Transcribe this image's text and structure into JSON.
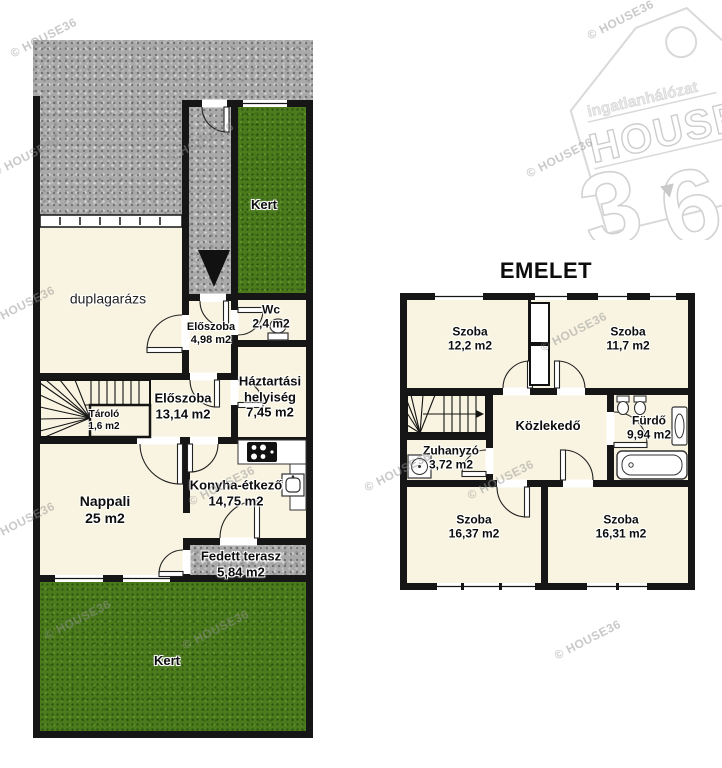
{
  "watermark": {
    "text": "© HOUSE36"
  },
  "logo": {
    "network": "ingatlanhálózat",
    "brand": "HOUSE",
    "digit_left": "3",
    "digit_right": "6"
  },
  "ground_floor": {
    "garage": {
      "name": "duplagarázs"
    },
    "kert_top": {
      "name": "Kert"
    },
    "wc": {
      "name": "Wc",
      "area": "2,4 m2"
    },
    "eloszoba_small": {
      "name": "Előszoba",
      "area": "4,98 m2"
    },
    "eloszoba_large": {
      "name": "Előszoba",
      "area": "13,14 m2"
    },
    "haztartasi": {
      "name_line1": "Háztartási",
      "name_line2": "helyiség",
      "area": "7,45 m2"
    },
    "tarolo": {
      "name": "Tároló",
      "area": "1,6 m2"
    },
    "nappali": {
      "name": "Nappali",
      "area": "25 m2"
    },
    "konyha": {
      "name": "Konyha-étkező",
      "area": "14,75 m2"
    },
    "terasz": {
      "name": "Fedett terasz",
      "area": "5,84 m2"
    },
    "kert_bottom": {
      "name": "Kert"
    }
  },
  "upper_floor": {
    "title": "EMELET",
    "szoba_top_left": {
      "name": "Szoba",
      "area": "12,2 m2"
    },
    "szoba_top_right": {
      "name": "Szoba",
      "area": "11,7 m2"
    },
    "kozlekedo": {
      "name": "Közlekedő"
    },
    "furdo": {
      "name": "Fürdő",
      "area": "9,94 m2"
    },
    "zuhanyzo": {
      "name": "Zuhanyzó",
      "area": "3,72 m2"
    },
    "szoba_bottom_left": {
      "name": "Szoba",
      "area": "16,37 m2"
    },
    "szoba_bottom_right": {
      "name": "Szoba",
      "area": "16,31 m2"
    }
  },
  "colors": {
    "wall": "#161616",
    "room_fill": "#f8f4e1",
    "grass": "#4b7b1d",
    "gravel": "#a9a9a9",
    "watermark_gray": "#bdbdbd"
  }
}
